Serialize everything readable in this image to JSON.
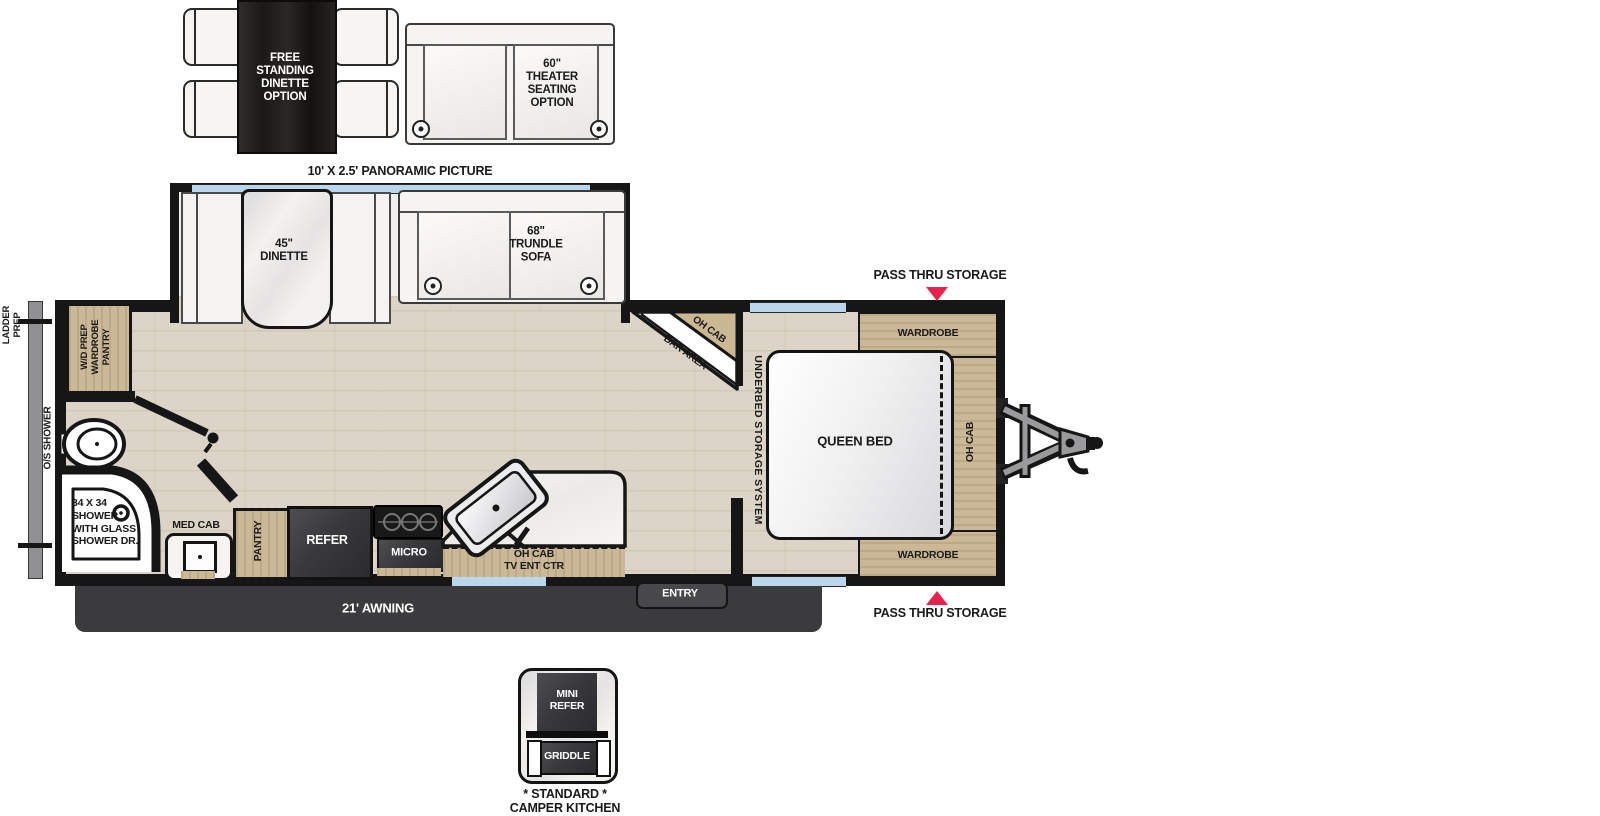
{
  "options": {
    "dinette_label": "FREE\nSTANDING\nDINETTE\nOPTION",
    "theater_label": "60\"\nTHEATER\nSEATING\nOPTION",
    "panoramic_label": "10' X 2.5' PANORAMIC PICTURE"
  },
  "slideout": {
    "dinette_label": "45\"\nDINETTE",
    "trundle_label": "68\"\nTRUNDLE\nSOFA"
  },
  "bathroom": {
    "wd_label": "W/D PREP\nWARDROBE\nPANTRY",
    "shower_label": "34 X 34\nSHOWER\nWITH GLASS\nSHOWER DR.",
    "medcab_label": "MED CAB"
  },
  "kitchen": {
    "pantry_label": "PANTRY",
    "refer_label": "REFER",
    "micro_label": "MICRO",
    "tv_label": "OH CAB\nTV ENT CTR",
    "bar_ohcab_label": "OH CAB",
    "bar_label": "BAR AREA"
  },
  "bedroom": {
    "underbed_label": "UNDERBED STORAGE SYSTEM",
    "bed_label": "QUEEN BED",
    "ohcab_label": "OH CAB",
    "wardrobe_top_label": "WARDROBE",
    "wardrobe_bottom_label": "WARDROBE"
  },
  "exterior": {
    "ladder_label": "LADDER\nPREP",
    "os_shower_label": "O/S SHOWER",
    "awning_label": "21' AWNING",
    "entry_label": "ENTRY",
    "pass_thru_top_label": "PASS THRU STORAGE",
    "pass_thru_bottom_label": "PASS THRU STORAGE"
  },
  "camper_kitchen": {
    "mini_refer_label": "MINI\nREFER",
    "griddle_label": "GRIDDLE",
    "caption_line1": "* STANDARD *",
    "caption_line2": "CAMPER KITCHEN"
  },
  "colors": {
    "accent_red": "#e8224c",
    "window_blue": "#b9d6ea",
    "wood_tan": "#cbb896",
    "appliance_dark": "#3c3c3f",
    "wall_black": "#161616"
  }
}
